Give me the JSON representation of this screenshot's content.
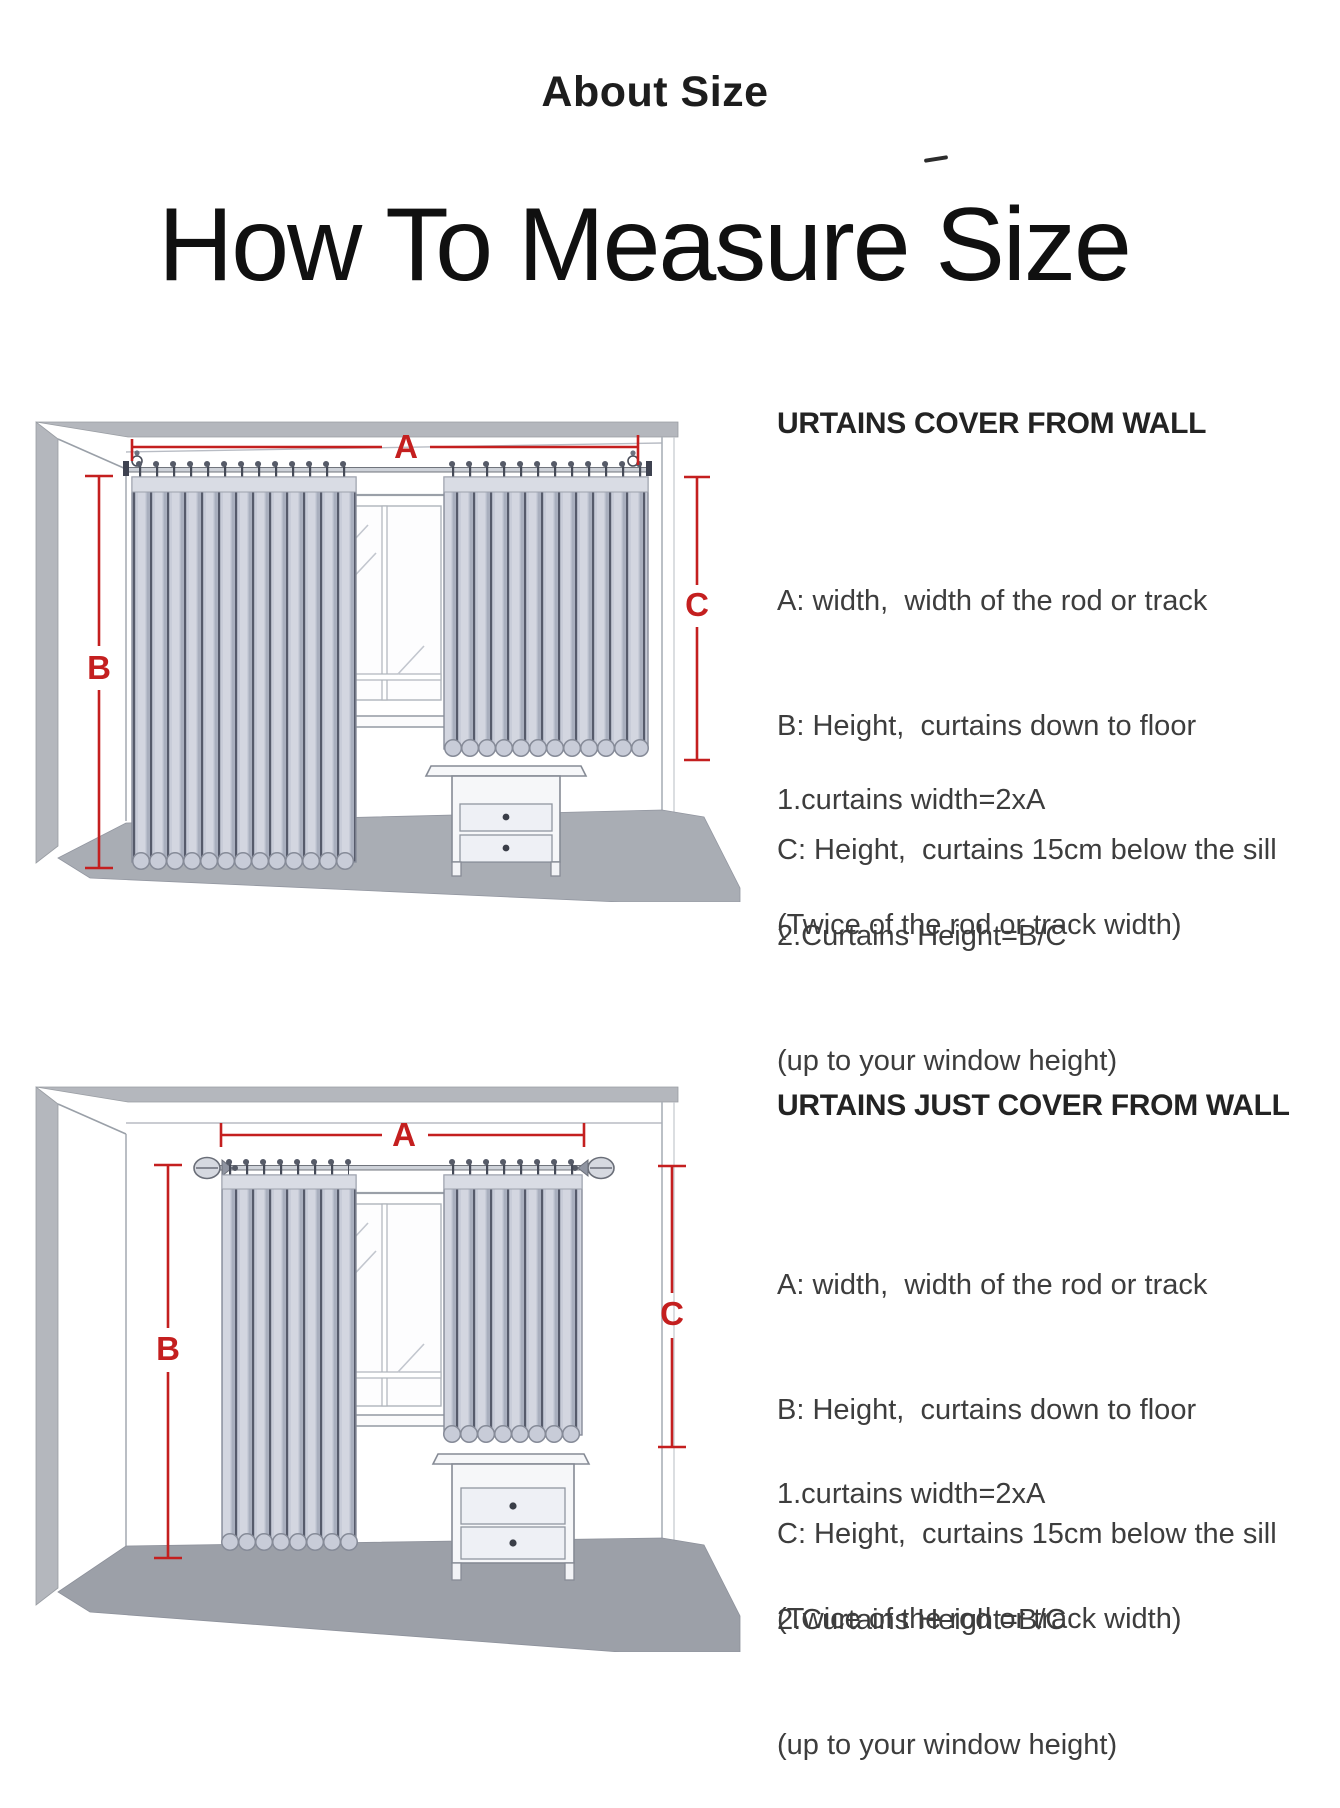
{
  "page": {
    "title_small": "About Size",
    "title_large": "How To Measure Size"
  },
  "measure_labels": {
    "a": "A",
    "b": "B",
    "c": "C"
  },
  "sections": [
    {
      "heading": "URTAINS COVER FROM WALL",
      "definitions": [
        "A: width,  width of the rod or track",
        "B: Height,  curtains down to floor",
        "C: Height,  curtains 15cm below the sill"
      ],
      "formula_width": [
        "1.curtains width=2xA",
        "(Twice of the rod or track width)"
      ],
      "formula_height": [
        "2.Curtains Height=B/C",
        "(up to your window height)"
      ]
    },
    {
      "heading": "URTAINS JUST COVER FROM WALL",
      "definitions": [
        "A: width,  width of the rod or track",
        "B: Height,  curtains down to floor",
        "C: Height,  curtains 15cm below the sill"
      ],
      "formula_width": [
        "1.curtains width=2xA",
        "(Twice of the rod or track width)"
      ],
      "formula_height": [
        "2.Curtains Height=B/C",
        "(up to your window height)"
      ]
    }
  ],
  "colors": {
    "measure_red": "#c41f1f",
    "wall_gray": "#b4b7bd",
    "floor_gray_top": "#a9adb4",
    "floor_gray_bottom": "#9ca0a8",
    "curtain_base": "#c8ccd8",
    "curtain_fold_dark": "#565b6b",
    "heading_text": "#232323",
    "body_text": "#3d3d3d"
  }
}
